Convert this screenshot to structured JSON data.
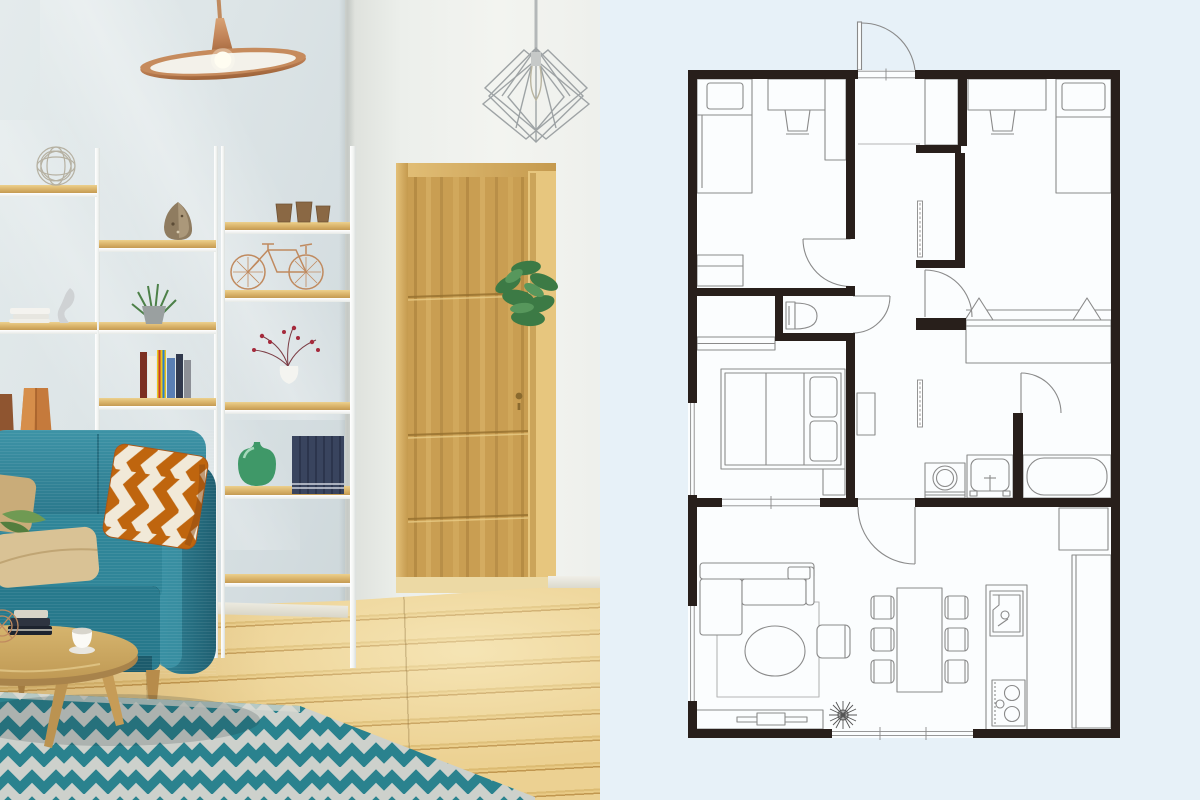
{
  "page": {
    "title": "interior-photo-with-floor-plan",
    "split": "photo-left-plan-right"
  },
  "photo": {
    "label": "scandinavian-living-room-photo",
    "colors": {
      "wall": "#dde5e7",
      "wall_right": "#eef0ec",
      "sofa_teal": "#2e8799",
      "rug_teal": "#2b8794",
      "rug_base": "#e2e1da",
      "floor_wood": "#e4c584",
      "door_wood": "#c99e52",
      "shelf_wood": "#d9b269",
      "accent_pillow": "#bf650e",
      "copper": "#c08a5f",
      "plant_green": "#45814a"
    },
    "items": [
      "copper-disc-pendant-lamp",
      "wire-diamond-pendant-lamp",
      "white-ladder-shelving",
      "wire-ball",
      "decorative-stone",
      "clay-cups",
      "copper-bicycle-model",
      "white-books",
      "figurine",
      "potted-succulent",
      "colorful-books",
      "berry-branch-vase",
      "green-glass-vase",
      "navy-book-set",
      "copper-vases",
      "wooden-door",
      "door-plant",
      "teal-sofa",
      "beige-cushions",
      "chevron-cushion",
      "round-coffee-table",
      "book-stack",
      "coffee-cup",
      "zigzag-rug",
      "oak-floor"
    ]
  },
  "plan": {
    "label": "two-bedroom-apartment-floor-plan",
    "colors": {
      "page_bg": "#e7f1f8",
      "room_floor": "#fbfdfe",
      "walls": "#281f1b",
      "furniture_line": "#8a8a8a"
    },
    "rooms": [
      {
        "name": "bedroom-1"
      },
      {
        "name": "bedroom-2"
      },
      {
        "name": "entry-hall"
      },
      {
        "name": "toilet"
      },
      {
        "name": "master-bedroom"
      },
      {
        "name": "washroom"
      },
      {
        "name": "bathroom"
      },
      {
        "name": "living-dining-kitchen"
      }
    ],
    "furniture": [
      "single-bed",
      "desk-with-chair",
      "wardrobe",
      "low-cabinet",
      "single-bed-2",
      "desk-with-chair-2",
      "hall-closets",
      "hanging-closet",
      "double-bed",
      "nightstand",
      "toilet-fixture",
      "washing-machine",
      "vanity-sink",
      "bathtub",
      "fridge",
      "kitchen-island",
      "island-sink",
      "stove",
      "side-counter",
      "dining-table",
      "six-chairs",
      "corner-sofa",
      "round-coffee-table",
      "armchair",
      "area-rug",
      "tv-stand",
      "plant"
    ],
    "openings": [
      "entry-door",
      "bedroom-1-door",
      "toilet-door",
      "bedroom-2-door",
      "bathroom-door",
      "living-room-door",
      "sliding-doors",
      "windows"
    ]
  }
}
